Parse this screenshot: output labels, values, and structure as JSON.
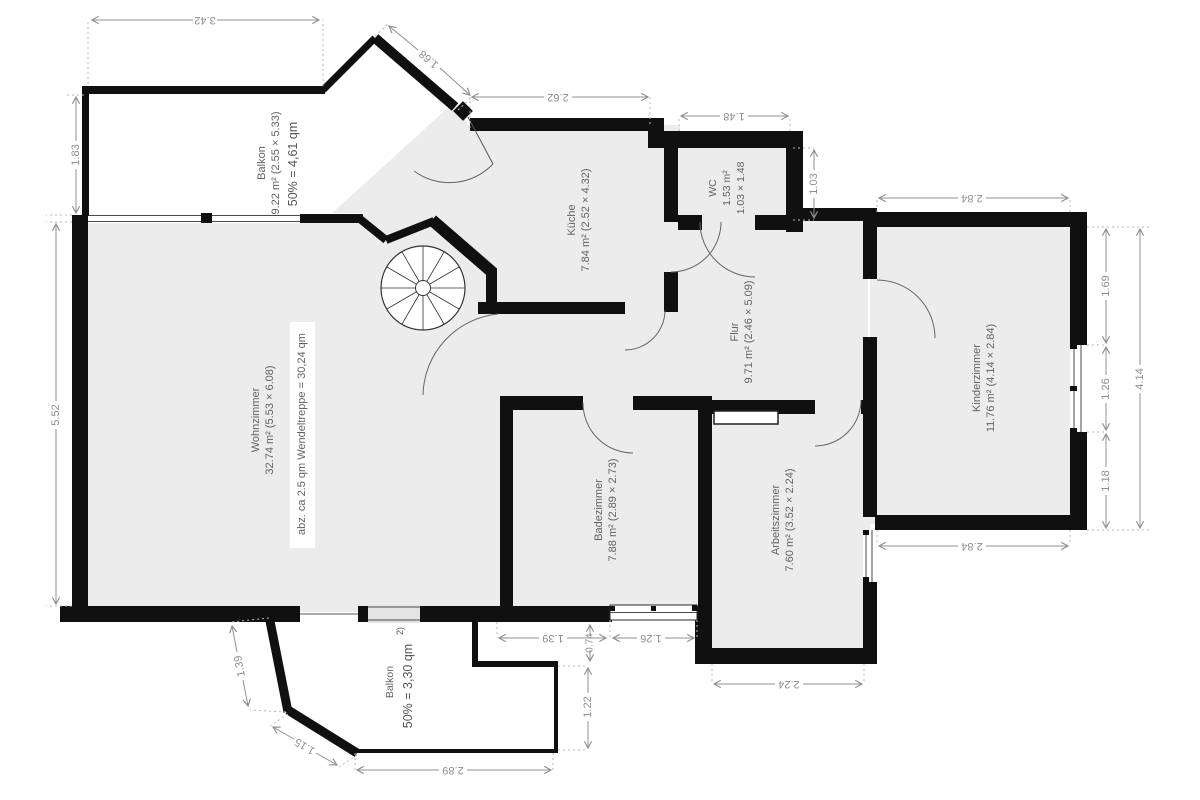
{
  "plan": {
    "rooms": [
      {
        "name": "Balkon",
        "area": "9.22 m² (2.55 × 5.33)",
        "share": "50% = 4,61 qm"
      },
      {
        "name": "Wohnzimmer",
        "area": "32.74 m² (5.53 × 6.08)",
        "note": "abz. ca 2.5 qm Wendeltreppe = 30,24 qm"
      },
      {
        "name": "Küche",
        "area": "7.84 m² (2.52 × 4.32)"
      },
      {
        "name": "WC",
        "area": "1.53 m²",
        "size": "1.03 × 1.48"
      },
      {
        "name": "Flur",
        "area": "9.71 m² (2.46 × 5.09)"
      },
      {
        "name": "Kinderzimmer",
        "area": "11.76 m² (4.14 × 2.84)"
      },
      {
        "name": "Badezimmer",
        "area": "7.88 m² (2.89 × 2.73)"
      },
      {
        "name": "Arbeitszimmer",
        "area": "7.60 m² (3.52 × 2.24)"
      },
      {
        "name": "Balkon",
        "share": "50% = 3,30 qm",
        "footnote": "2)"
      }
    ],
    "dimensions": {
      "balcony_top_width": "3.42",
      "entry_wall": "1.68",
      "kitchen_width": "2.62",
      "wc_width": "1.48",
      "wc_height": "1.03",
      "balcony_left_height": "1.83",
      "living_left_height": "5.52",
      "child_top_width": "2.84",
      "child_right_upper": "1.69",
      "child_right_window": "1.26",
      "child_right_lower": "1.18",
      "child_right_total": "4.14",
      "child_bottom_width": "2.84",
      "office_bottom_width": "2.24",
      "bath_bottom_left": "1.39",
      "bath_bottom_step": "0.74",
      "bath_bottom_right": "1.26",
      "balcony2_step_height": "1.22",
      "balcony2_left": "1.39",
      "balcony2_diagonal": "1.15",
      "balcony2_bottom_width": "2.89"
    },
    "colors": {
      "wall": "#101010",
      "floor": "#ececec",
      "dimension": "#909090",
      "label": "#636363"
    }
  }
}
